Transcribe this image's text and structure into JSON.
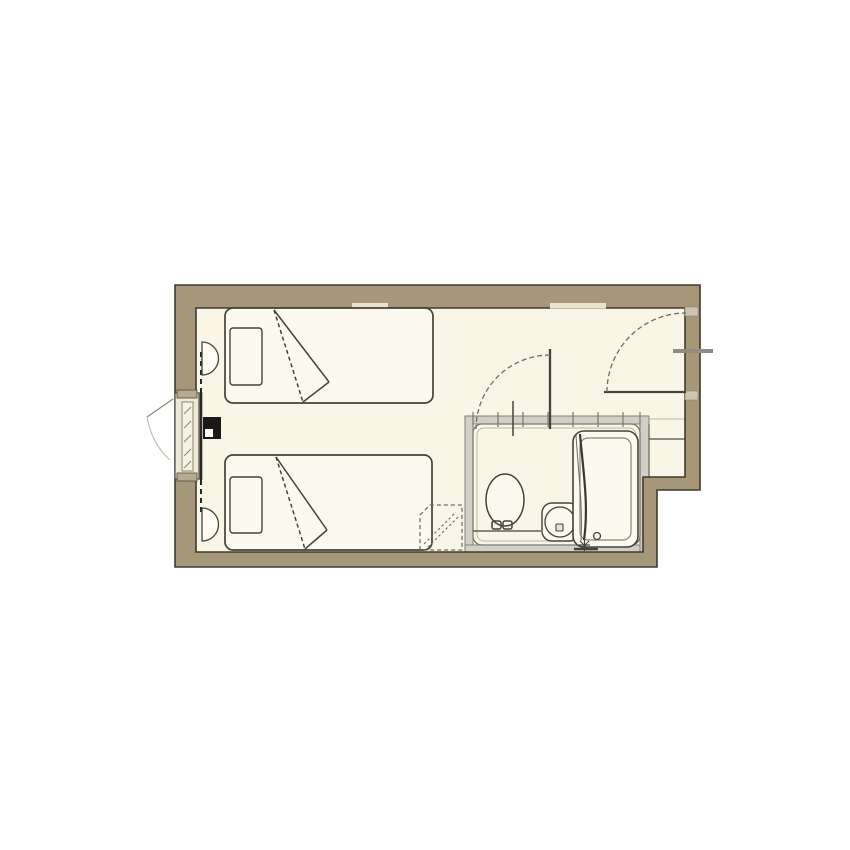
{
  "title": "Hotel twin room floor plan",
  "colors": {
    "wall": "#a59778",
    "wall_outline": "#3f3a30",
    "floor": "#faf6e7",
    "bed": "#fcfaef",
    "line": "#45423a",
    "bath_band": "#d2d0c6",
    "bath_line": "#7b786d",
    "bath_inner": "#b8b5a8",
    "sill": "#efe8d4",
    "bracket": "#b7aa8e",
    "jamb": "#cfc5ae",
    "notch": "#e9e3d0",
    "arc": "#6f6c63",
    "threshold": "#8f8c82",
    "console": "#1a1917",
    "background": "#ffffff"
  },
  "plan": {
    "rooms": [
      {
        "name": "bedroom"
      },
      {
        "name": "bathroom"
      },
      {
        "name": "entry"
      }
    ],
    "furniture": [
      {
        "name": "twin-bed-1"
      },
      {
        "name": "twin-bed-2"
      },
      {
        "name": "pillow-1"
      },
      {
        "name": "pillow-2"
      },
      {
        "name": "bedside-console"
      },
      {
        "name": "wall-lamp-1"
      },
      {
        "name": "wall-lamp-2"
      },
      {
        "name": "luggage-rack"
      }
    ],
    "fixtures": [
      {
        "name": "toilet"
      },
      {
        "name": "sink"
      },
      {
        "name": "bathtub"
      },
      {
        "name": "shower-hose"
      },
      {
        "name": "faucet"
      }
    ],
    "openings": [
      {
        "name": "entrance-door",
        "swing": "inward"
      },
      {
        "name": "bathroom-door",
        "swing": "inward"
      },
      {
        "name": "window",
        "swing": "outward"
      }
    ]
  }
}
